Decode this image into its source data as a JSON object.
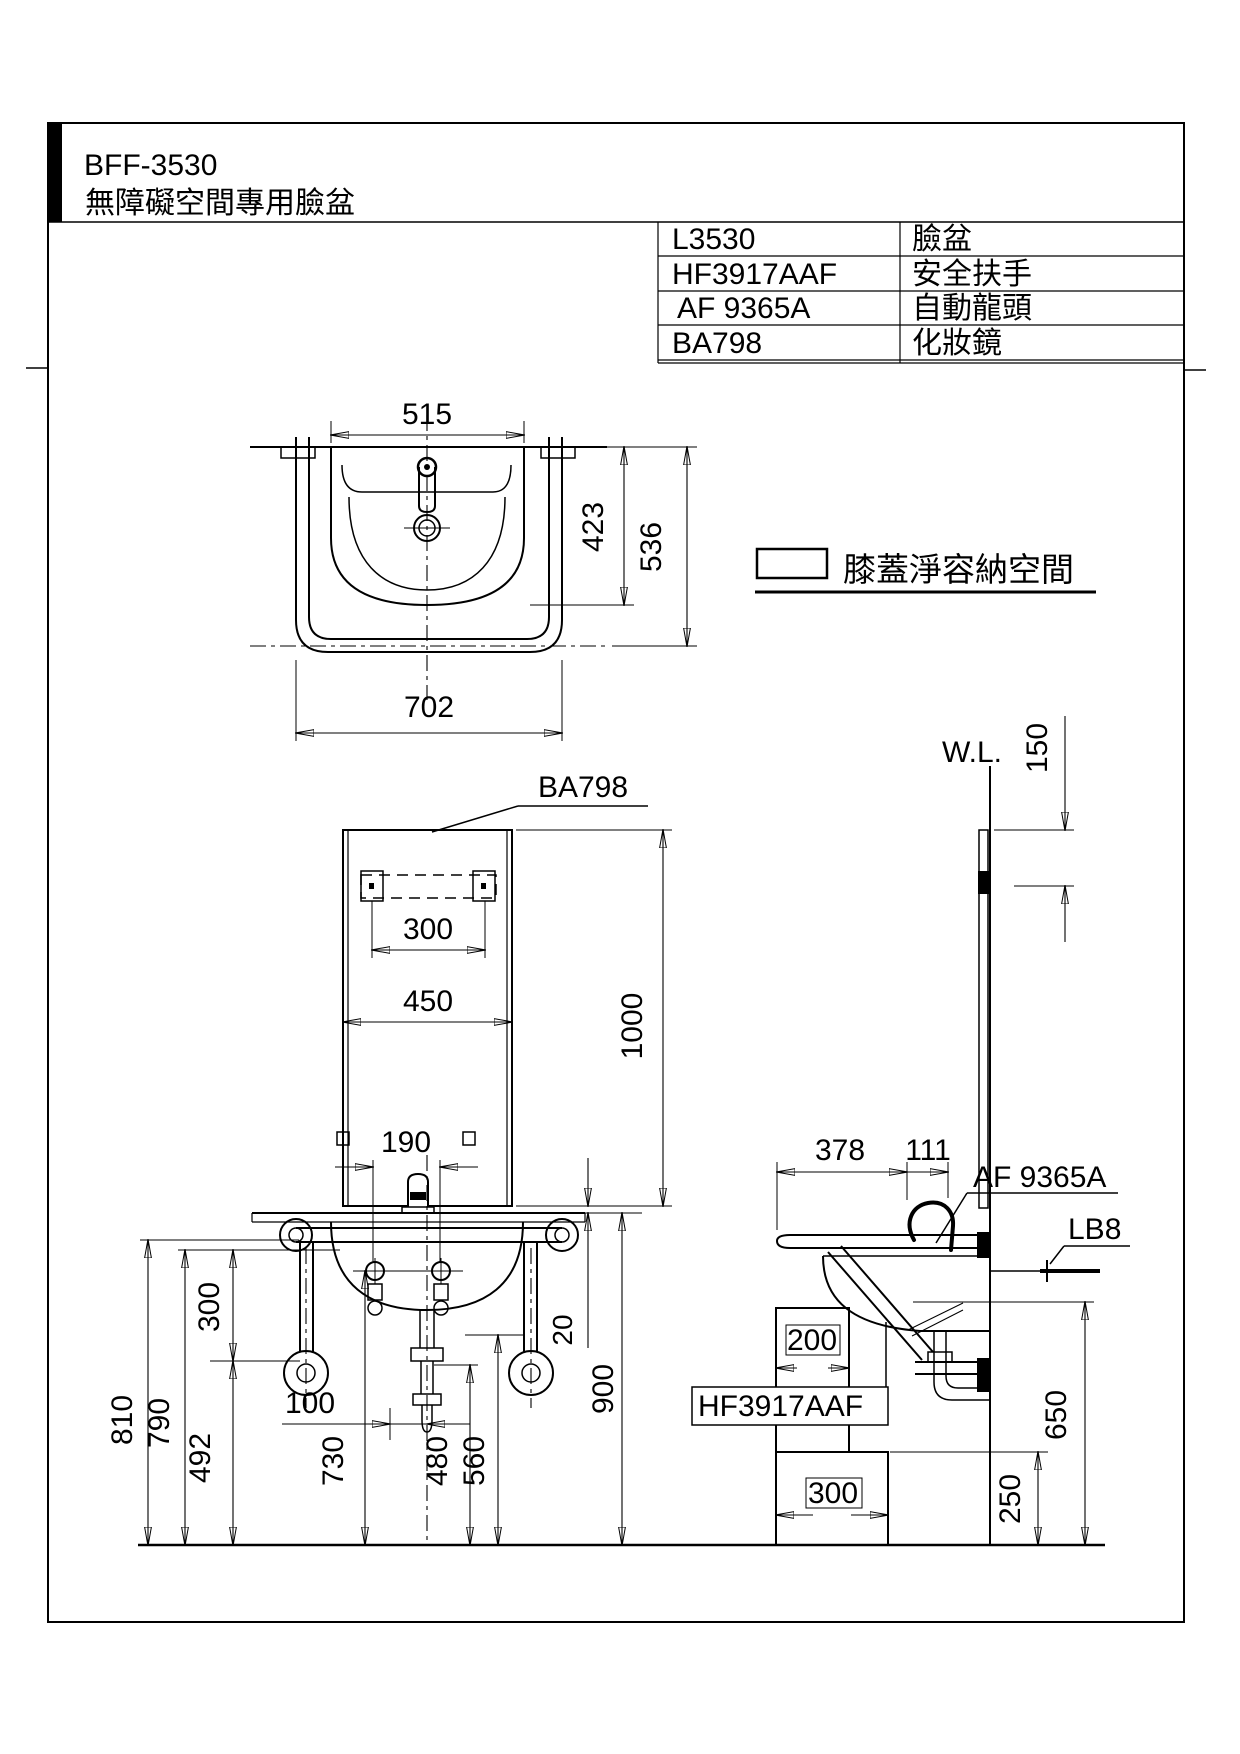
{
  "header": {
    "model": "BFF-3530",
    "subtitle": "無障礙空間專用臉盆"
  },
  "parts_table": {
    "rows": [
      {
        "code": "L3530",
        "name": "臉盆"
      },
      {
        "code": "HF3917AAF",
        "name": "安全扶手"
      },
      {
        "code": "AF 9365A",
        "name": "自動龍頭"
      },
      {
        "code": "BA798",
        "name": "化妝鏡"
      }
    ]
  },
  "legend": {
    "knee_space_label": "膝蓋淨容納空間"
  },
  "top_view": {
    "dims": {
      "basin_width": "515",
      "basin_depth": "423",
      "total_depth": "536",
      "total_width": "702"
    }
  },
  "front_view": {
    "mirror_label": "BA798",
    "dims": {
      "bracket_width": "300",
      "mirror_width": "450",
      "mirror_height": "1000",
      "faucet_holes": "190",
      "mirror_gap": "20",
      "deck_height": "900",
      "rail_height": "810",
      "rim_height": "790",
      "flange_height": "492",
      "flange_offset": "300",
      "drain_offset": "100",
      "stop_height": "730",
      "trap_height": "480",
      "outlet_height": "560"
    }
  },
  "side_view": {
    "wall_line_label": "W.L.",
    "faucet_label": "AF 9365A",
    "bolt_label": "LB8",
    "grab_bar_label": "HF3917AAF",
    "dims": {
      "mirror_top_offset": "150",
      "rail_depth": "378",
      "spout_offset": "111",
      "knee_upper_depth": "200",
      "knee_lower_depth": "300",
      "knee_height": "650",
      "knee_lower_height": "250"
    }
  }
}
